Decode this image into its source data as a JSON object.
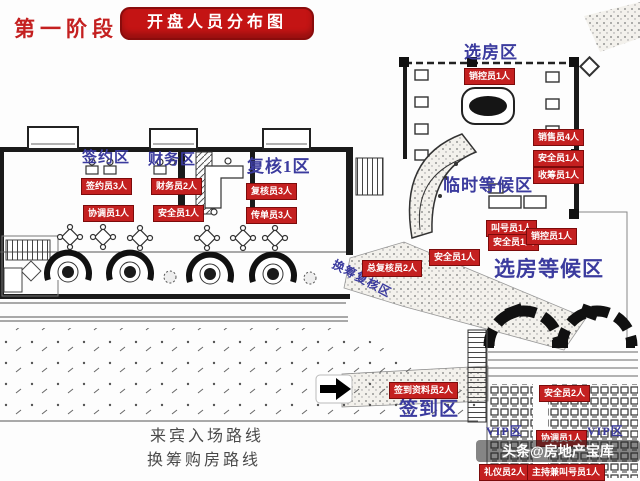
{
  "header": {
    "phase_label": "第一阶段",
    "title": "开盘人员分布图"
  },
  "colors": {
    "badge_red": "#c42020",
    "zone_blue": "#3b3b9e",
    "banner_red": "#c41414"
  },
  "zones": [
    {
      "label": "签约区",
      "x": 82,
      "y": 151,
      "size": 15
    },
    {
      "label": "财务区",
      "x": 148,
      "y": 153,
      "size": 15
    },
    {
      "label": "复核1区",
      "x": 247,
      "y": 158,
      "size": 17
    },
    {
      "label": "选房区",
      "x": 464,
      "y": 44,
      "size": 17
    },
    {
      "label": "临时等候区",
      "x": 443,
      "y": 177,
      "size": 17
    },
    {
      "label": "选房等候区",
      "x": 494,
      "y": 258,
      "size": 21
    },
    {
      "label": "换筹复核区",
      "x": 336,
      "y": 258,
      "size": 12,
      "rotate": 28
    },
    {
      "label": "签到区",
      "x": 399,
      "y": 400,
      "size": 19
    },
    {
      "label": "VIP区",
      "x": 486,
      "y": 425,
      "size": 12
    },
    {
      "label": "VIP区",
      "x": 587,
      "y": 425,
      "size": 12
    }
  ],
  "badges": [
    {
      "label": "签约员3人",
      "x": 81,
      "y": 178
    },
    {
      "label": "财务员2人",
      "x": 151,
      "y": 178
    },
    {
      "label": "复核员3人",
      "x": 246,
      "y": 183
    },
    {
      "label": "协调员1人",
      "x": 83,
      "y": 205
    },
    {
      "label": "安全员1人",
      "x": 153,
      "y": 205
    },
    {
      "label": "传单员3人",
      "x": 246,
      "y": 207
    },
    {
      "label": "销控员1人",
      "x": 464,
      "y": 68
    },
    {
      "label": "销售员4人",
      "x": 533,
      "y": 129
    },
    {
      "label": "安全员1人",
      "x": 533,
      "y": 150
    },
    {
      "label": "收筹员1人",
      "x": 533,
      "y": 167
    },
    {
      "label": "叫号员1人",
      "x": 486,
      "y": 220
    },
    {
      "label": "安全员1人",
      "x": 488,
      "y": 234
    },
    {
      "label": "销控员1人",
      "x": 526,
      "y": 228
    },
    {
      "label": "安全员1人",
      "x": 429,
      "y": 249
    },
    {
      "label": "总复核员2人",
      "x": 362,
      "y": 260
    },
    {
      "label": "签到资料员2人",
      "x": 389,
      "y": 382
    },
    {
      "label": "安全员2人",
      "x": 539,
      "y": 385
    },
    {
      "label": "协调员1人",
      "x": 536,
      "y": 430
    },
    {
      "label": "礼仪员2人",
      "x": 479,
      "y": 464
    },
    {
      "label": "主持兼叫号员1人",
      "x": 527,
      "y": 464
    }
  ],
  "legend": {
    "routes": [
      {
        "label": "来宾入场路线",
        "x": 150,
        "y": 422
      },
      {
        "label": "换筹购房路线",
        "x": 147,
        "y": 446
      }
    ]
  },
  "watermark": {
    "text": "头条@房地产宝库"
  }
}
